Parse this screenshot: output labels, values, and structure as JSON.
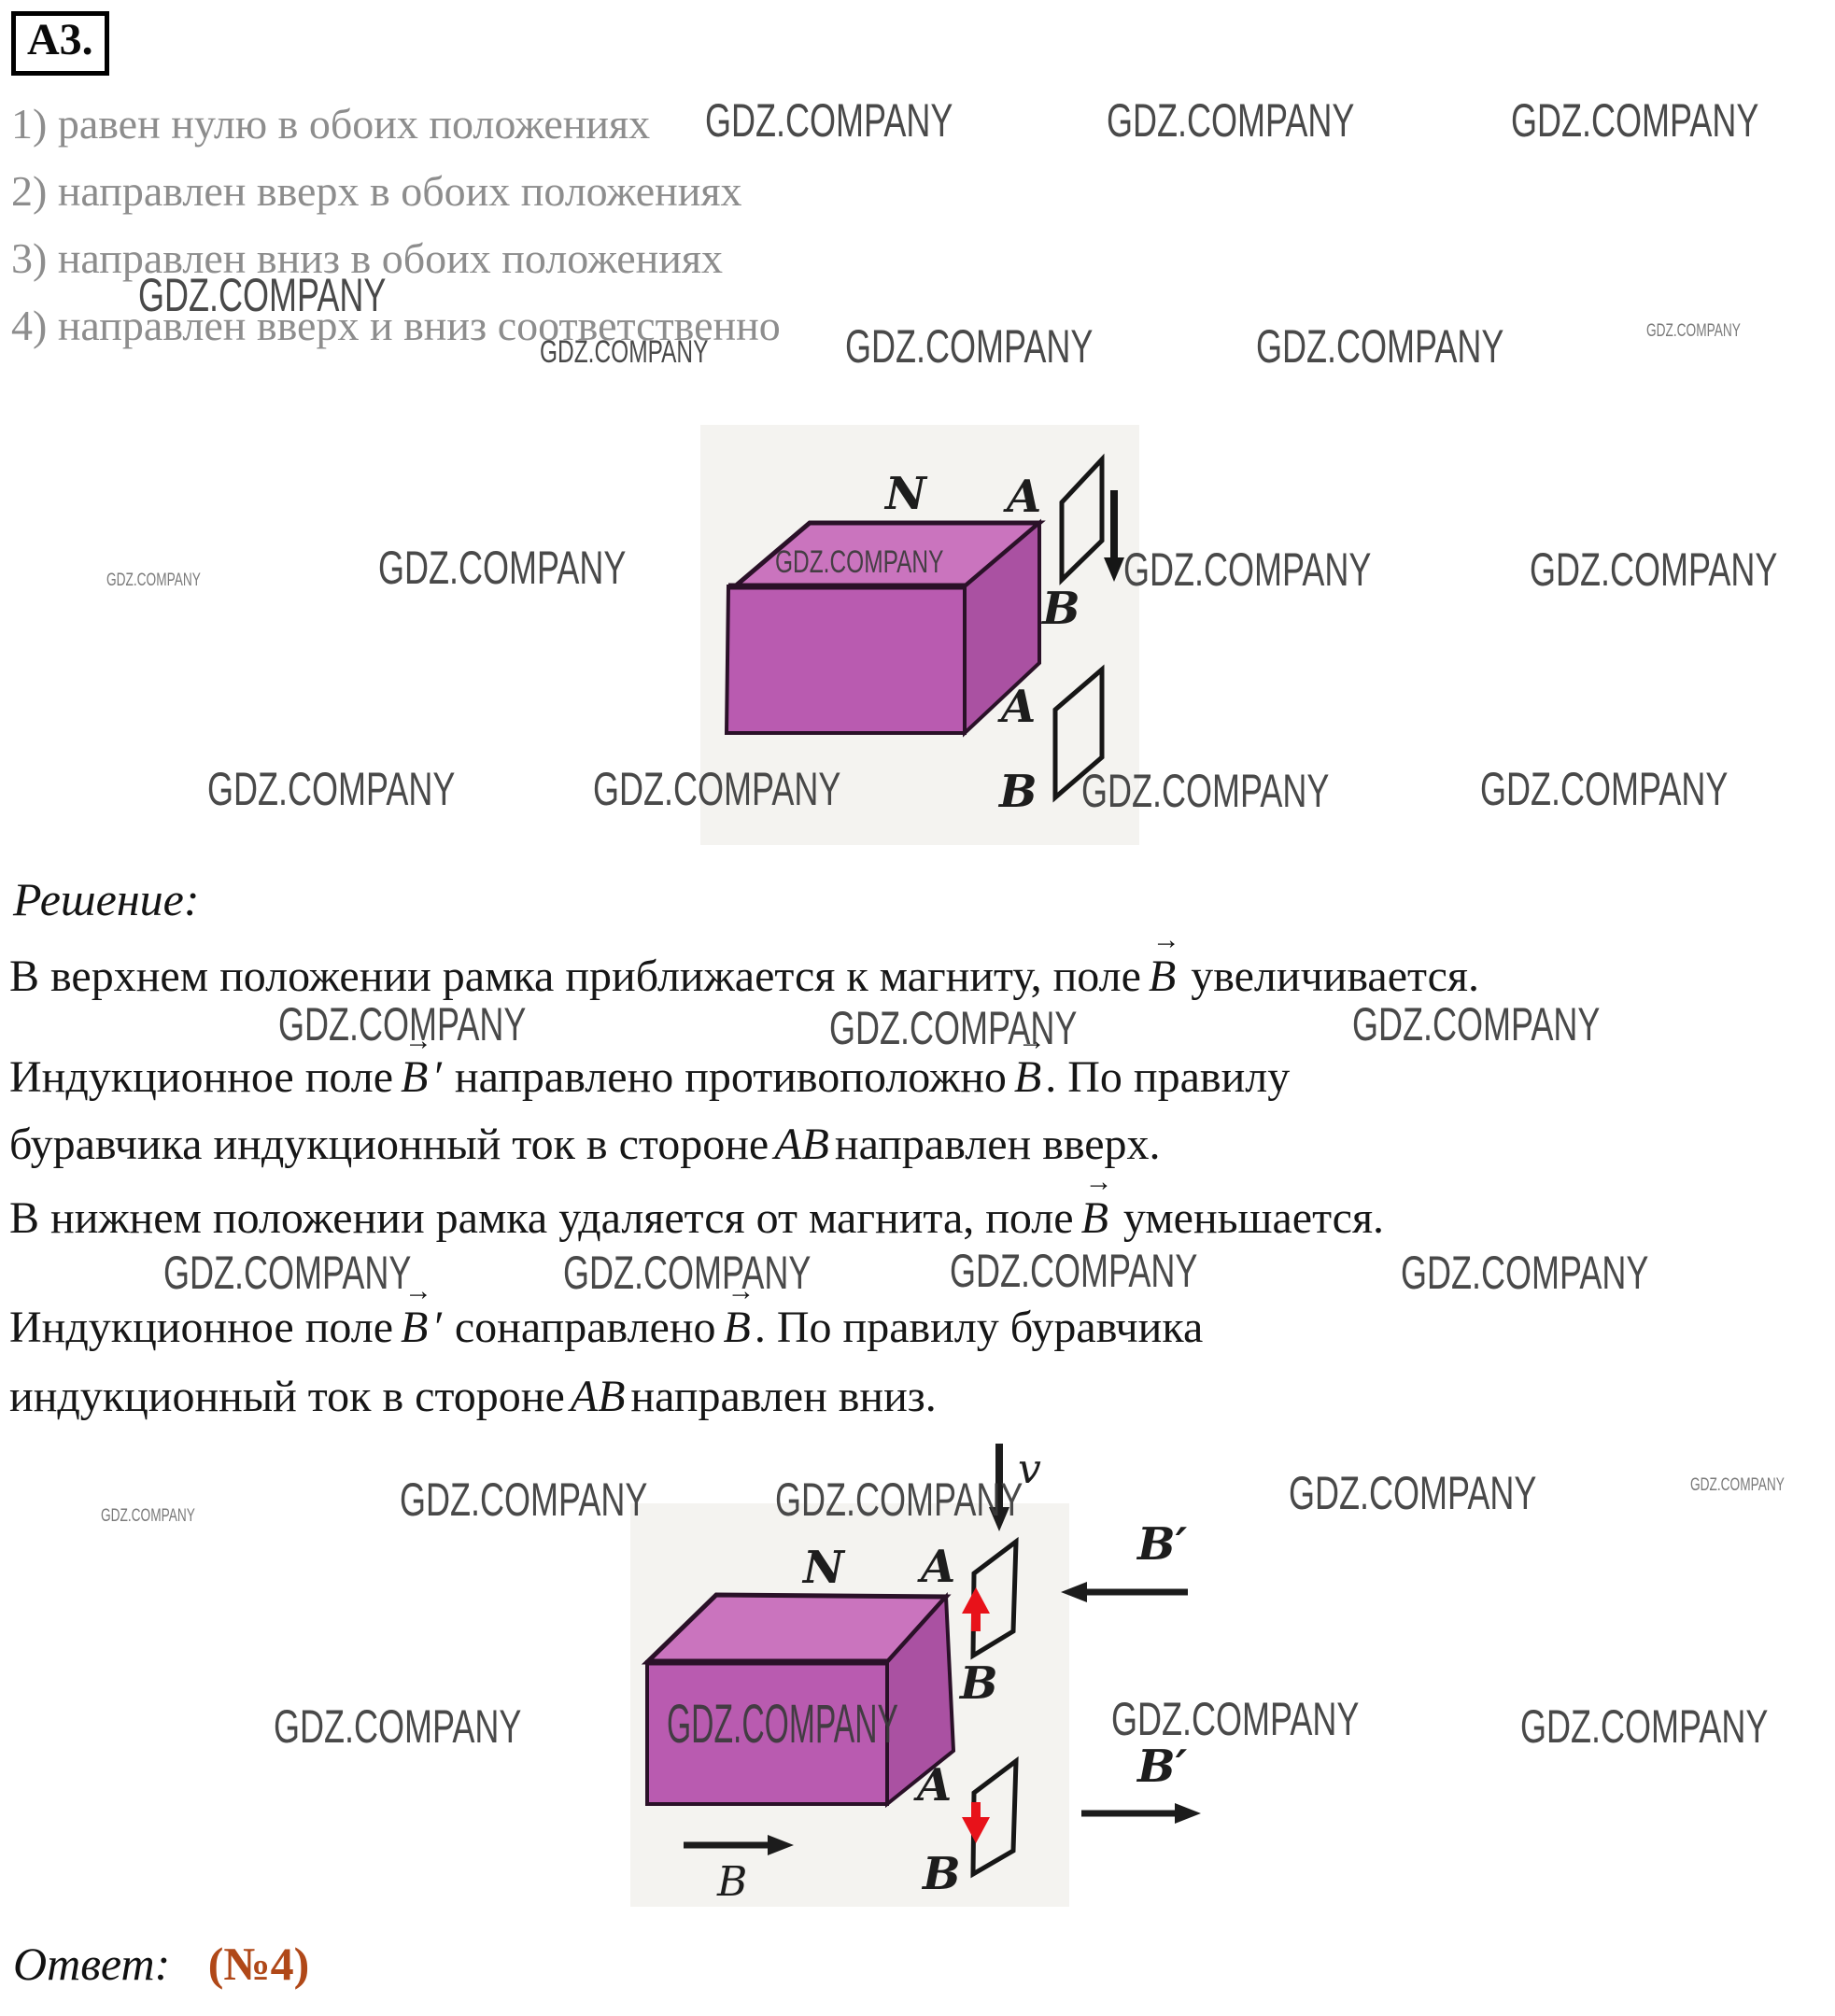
{
  "header": {
    "label": "А3."
  },
  "options": [
    "1) равен нулю в обоих положениях",
    "2) направлен вверх в обоих положениях",
    "3) направлен вниз в обоих положениях",
    "4) направлен вверх и вниз соответственно"
  ],
  "solution": {
    "title": "Решение:",
    "l1": {
      "pre": "В верхнем положении рамка приближается к магниту, поле",
      "v1": "B",
      "post": "увеличивается."
    },
    "l2": {
      "pre": "Индукционное поле",
      "v1": "B",
      "prime": "′",
      "mid": "направлено противоположно",
      "v2": "B",
      "post": ". По правилу"
    },
    "l3": {
      "pre": "буравчика индукционный ток в стороне",
      "ab": "AB",
      "post": "направлен вверх."
    },
    "l4": {
      "pre": "В нижнем положении рамка удаляется от магнита, поле",
      "v1": "B",
      "post": "уменьшается."
    },
    "l5": {
      "pre": "Индукционное поле",
      "v1": "B",
      "prime": "′",
      "mid": "сонаправлено",
      "v2": "B",
      "post": ". По правилу буравчика"
    },
    "l6": {
      "pre": "индукционный ток в стороне",
      "ab": "AB",
      "post": "направлен вниз."
    }
  },
  "answer": {
    "label": "Ответ:",
    "value": "(№4)"
  },
  "watermark": {
    "text": "GDZ.COMPANY"
  },
  "fig1": {
    "n": "N",
    "a_top": "A",
    "b_top": "B",
    "a_bottom": "A",
    "b_bottom": "B"
  },
  "fig2": {
    "v": "v",
    "n": "N",
    "a_top": "A",
    "b_top": "B",
    "a_bottom": "A",
    "b_bottom": "B",
    "b_prime_top": "B′",
    "b_prime_bottom": "B′",
    "b_label": "B"
  },
  "colors": {
    "answer_accent": "#b04818",
    "magnet_front": "#b95bb0",
    "magnet_top": "#ca74be",
    "magnet_side": "#aa51a2",
    "induced_arrow_red": "#e8121a",
    "figure_bg": "#f4f3f0",
    "option_text": "#8d8d8d"
  }
}
